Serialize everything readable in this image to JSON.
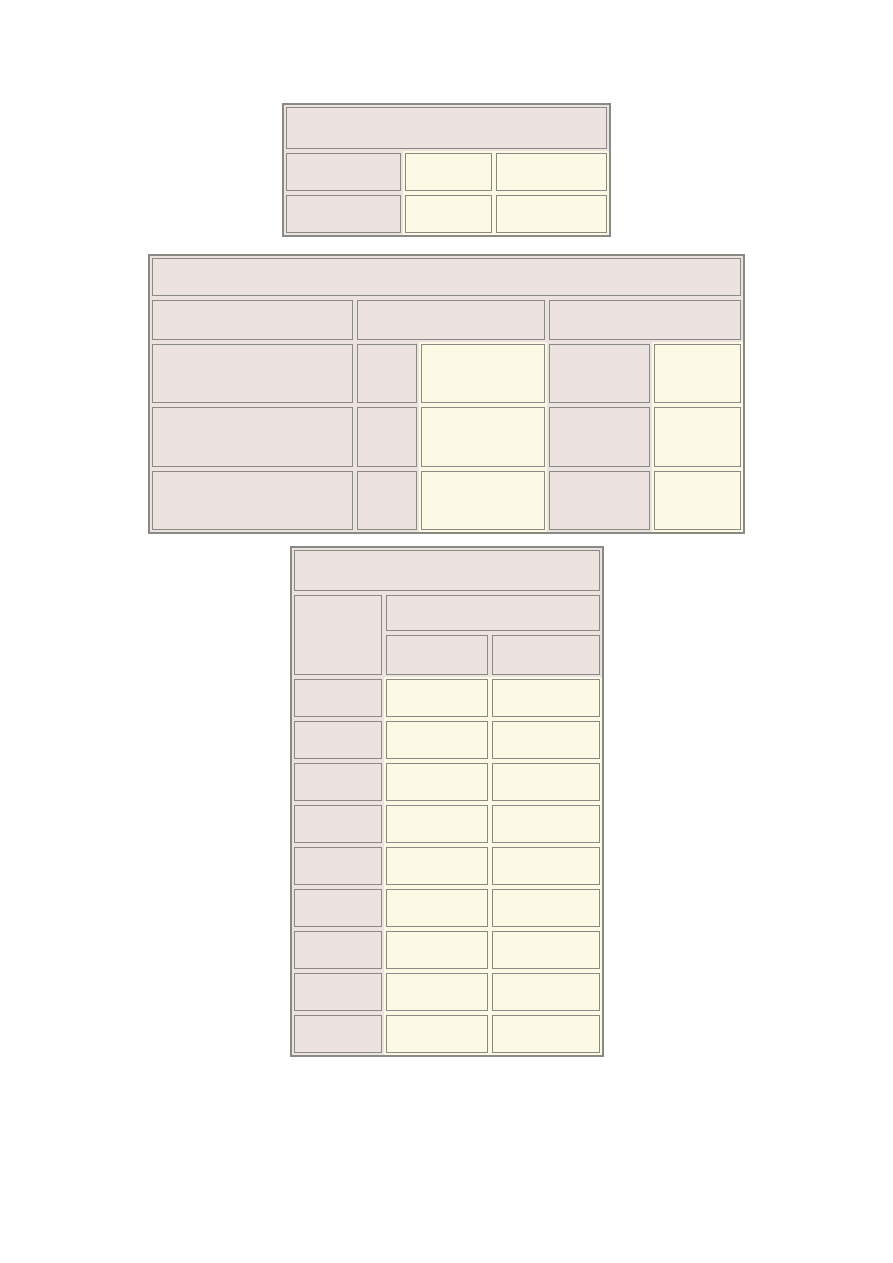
{
  "document": {
    "page_background": "#ffffff",
    "colors": {
      "header_cell_fill": "#ece3e0",
      "body_cell_fill": "#fcf9e5",
      "cell_border": "#8a8a85",
      "table_border": "#8a8a85"
    },
    "tables": [
      {
        "id": "top-table",
        "left": 282,
        "top": 103,
        "width": 329,
        "height": 134,
        "col_widths_pct": [
          36.6,
          28.0,
          35.4
        ],
        "row_heights": [
          46,
          42,
          42
        ],
        "rows": [
          [
            {
              "fill": "header",
              "colspan": 3,
              "text": ""
            }
          ],
          [
            {
              "fill": "header",
              "text": ""
            },
            {
              "fill": "body",
              "text": ""
            },
            {
              "fill": "body",
              "text": ""
            }
          ],
          [
            {
              "fill": "header",
              "text": ""
            },
            {
              "fill": "body",
              "text": ""
            },
            {
              "fill": "body",
              "text": ""
            }
          ]
        ]
      },
      {
        "id": "middle-table",
        "left": 148,
        "top": 254,
        "width": 597,
        "height": 280,
        "col_widths_pct": [
          34.6,
          10.8,
          21.6,
          17.7,
          15.3
        ],
        "row_heights": [
          42,
          44,
          63,
          64,
          63
        ],
        "rows": [
          [
            {
              "fill": "header",
              "colspan": 5,
              "text": ""
            }
          ],
          [
            {
              "fill": "header",
              "text": ""
            },
            {
              "fill": "header",
              "colspan": 2,
              "text": ""
            },
            {
              "fill": "header",
              "colspan": 2,
              "text": ""
            }
          ],
          [
            {
              "fill": "header",
              "text": ""
            },
            {
              "fill": "header",
              "text": ""
            },
            {
              "fill": "body",
              "text": ""
            },
            {
              "fill": "header",
              "text": ""
            },
            {
              "fill": "body",
              "text": ""
            }
          ],
          [
            {
              "fill": "header",
              "text": ""
            },
            {
              "fill": "header",
              "text": ""
            },
            {
              "fill": "body",
              "text": ""
            },
            {
              "fill": "header",
              "text": ""
            },
            {
              "fill": "body",
              "text": ""
            }
          ],
          [
            {
              "fill": "header",
              "text": ""
            },
            {
              "fill": "header",
              "text": ""
            },
            {
              "fill": "body",
              "text": ""
            },
            {
              "fill": "header",
              "text": ""
            },
            {
              "fill": "body",
              "text": ""
            }
          ]
        ]
      },
      {
        "id": "bottom-table",
        "left": 290,
        "top": 546,
        "width": 314,
        "height": 511,
        "col_widths_pct": [
          29.7,
          34.2,
          36.1
        ],
        "row_heights": [
          45,
          40,
          44,
          42,
          42,
          42,
          42,
          42,
          42,
          42,
          42,
          42
        ],
        "rows": [
          [
            {
              "fill": "header",
              "colspan": 3,
              "text": ""
            }
          ],
          [
            {
              "fill": "header",
              "rowspan": 2,
              "text": ""
            },
            {
              "fill": "header",
              "colspan": 2,
              "text": ""
            }
          ],
          [
            {
              "fill": "header",
              "text": ""
            },
            {
              "fill": "header",
              "text": ""
            }
          ],
          [
            {
              "fill": "header",
              "text": ""
            },
            {
              "fill": "body",
              "text": ""
            },
            {
              "fill": "body",
              "text": ""
            }
          ],
          [
            {
              "fill": "header",
              "text": ""
            },
            {
              "fill": "body",
              "text": ""
            },
            {
              "fill": "body",
              "text": ""
            }
          ],
          [
            {
              "fill": "header",
              "text": ""
            },
            {
              "fill": "body",
              "text": ""
            },
            {
              "fill": "body",
              "text": ""
            }
          ],
          [
            {
              "fill": "header",
              "text": ""
            },
            {
              "fill": "body",
              "text": ""
            },
            {
              "fill": "body",
              "text": ""
            }
          ],
          [
            {
              "fill": "header",
              "text": ""
            },
            {
              "fill": "body",
              "text": ""
            },
            {
              "fill": "body",
              "text": ""
            }
          ],
          [
            {
              "fill": "header",
              "text": ""
            },
            {
              "fill": "body",
              "text": ""
            },
            {
              "fill": "body",
              "text": ""
            }
          ],
          [
            {
              "fill": "header",
              "text": ""
            },
            {
              "fill": "body",
              "text": ""
            },
            {
              "fill": "body",
              "text": ""
            }
          ],
          [
            {
              "fill": "header",
              "text": ""
            },
            {
              "fill": "body",
              "text": ""
            },
            {
              "fill": "body",
              "text": ""
            }
          ],
          [
            {
              "fill": "header",
              "text": ""
            },
            {
              "fill": "body",
              "text": ""
            },
            {
              "fill": "body",
              "text": ""
            }
          ]
        ]
      }
    ]
  }
}
